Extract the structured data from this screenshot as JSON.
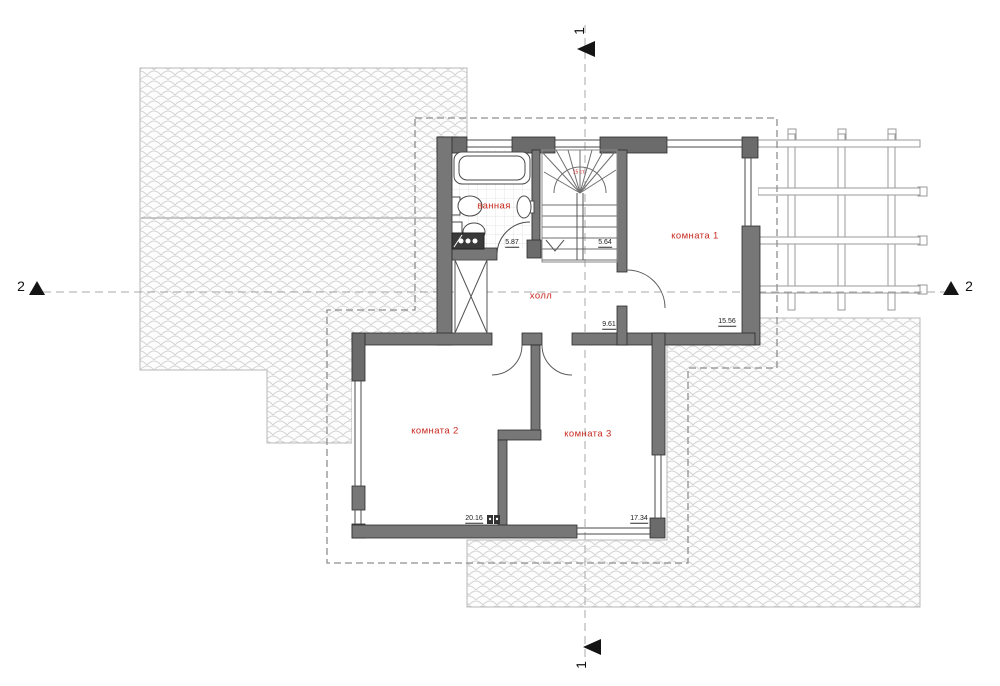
{
  "plan": {
    "title_hint": "second floor plan",
    "rooms": {
      "bathroom": "ванная",
      "hall": "холл",
      "room1": "комната 1",
      "room2": "комната 2",
      "room3": "комната 3",
      "stairs_note": "15 ст."
    },
    "dimensions": {
      "bathroom": "5.87",
      "stairs": "5.64",
      "hall": "9.61",
      "room1": "15.56",
      "room2": "20.16",
      "room3": "17.34"
    },
    "sections": {
      "s1": "1",
      "s2": "2"
    },
    "colors": {
      "label_red": "#c8281e",
      "wall_gray": "#777777",
      "pier_gray": "#6b6b6b",
      "outline_dark": "#2b2b2b",
      "hatch_line": "#d4d4d4",
      "dash_gray": "#8f8f8f",
      "marker_black": "#141414"
    }
  }
}
